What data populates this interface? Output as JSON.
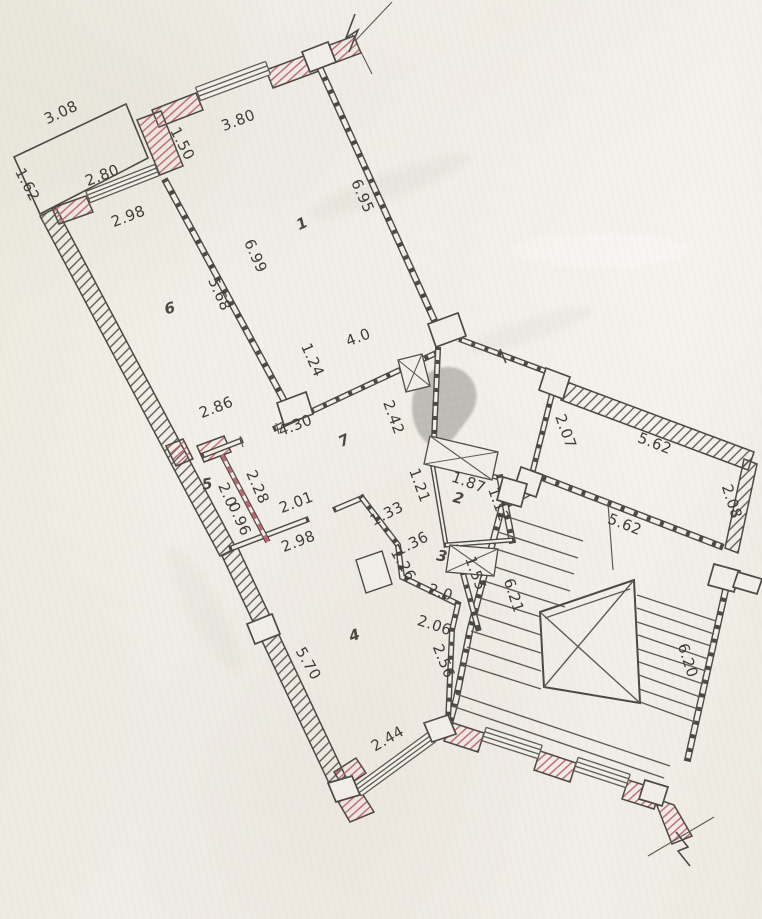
{
  "document": {
    "kind": "scanned architectural floor plan",
    "units": "meters"
  },
  "palette": {
    "paper": "#f1eee8",
    "ink": "#4b4742",
    "ink_thin": "#5d5952",
    "red_hatch": "#c4636f",
    "stain_gray": "#b6b3ae"
  },
  "room_labels": {
    "room1": "1",
    "room2": "2",
    "room3": "3",
    "room4": "4",
    "room5": "5",
    "room6": "6",
    "room7": "7"
  },
  "dimensions": {
    "balcony_width": "3.08",
    "balcony_depth": "1.62",
    "window_280": "2.80",
    "wall_298_top": "2.98",
    "jog_150": "1.50",
    "top_wall_380": "3.80",
    "room1_east_695": "6.95",
    "divider_699": "6.99",
    "divider_568": "5.68",
    "hall_40": "4.0",
    "door_124": "1.24",
    "hall_286": "2.86",
    "hall_430": "4.30",
    "wall_242": "2.42",
    "corridor_207": "2.07",
    "corridor_562_top": "5.62",
    "corridor_208": "2.08",
    "corridor_562_bottom": "5.62",
    "partition_228": "2.28",
    "hall_201": "2.01",
    "room5_20": "2.0",
    "room5_096": "0.96",
    "room4_298": "2.98",
    "wall_121": "1.21",
    "wall_133": "1.33",
    "room2_187": "1.87",
    "room2_112": "1.12",
    "wall_136": "1.36",
    "wall_126": "1.26",
    "room3_20": "2.0",
    "room3_206": "2.06",
    "wall_155": "1.55",
    "wall_256": "2.56",
    "stair_621": "6.21",
    "stair_620": "6.20",
    "room4_570": "5.70",
    "window_244": "2.44"
  }
}
